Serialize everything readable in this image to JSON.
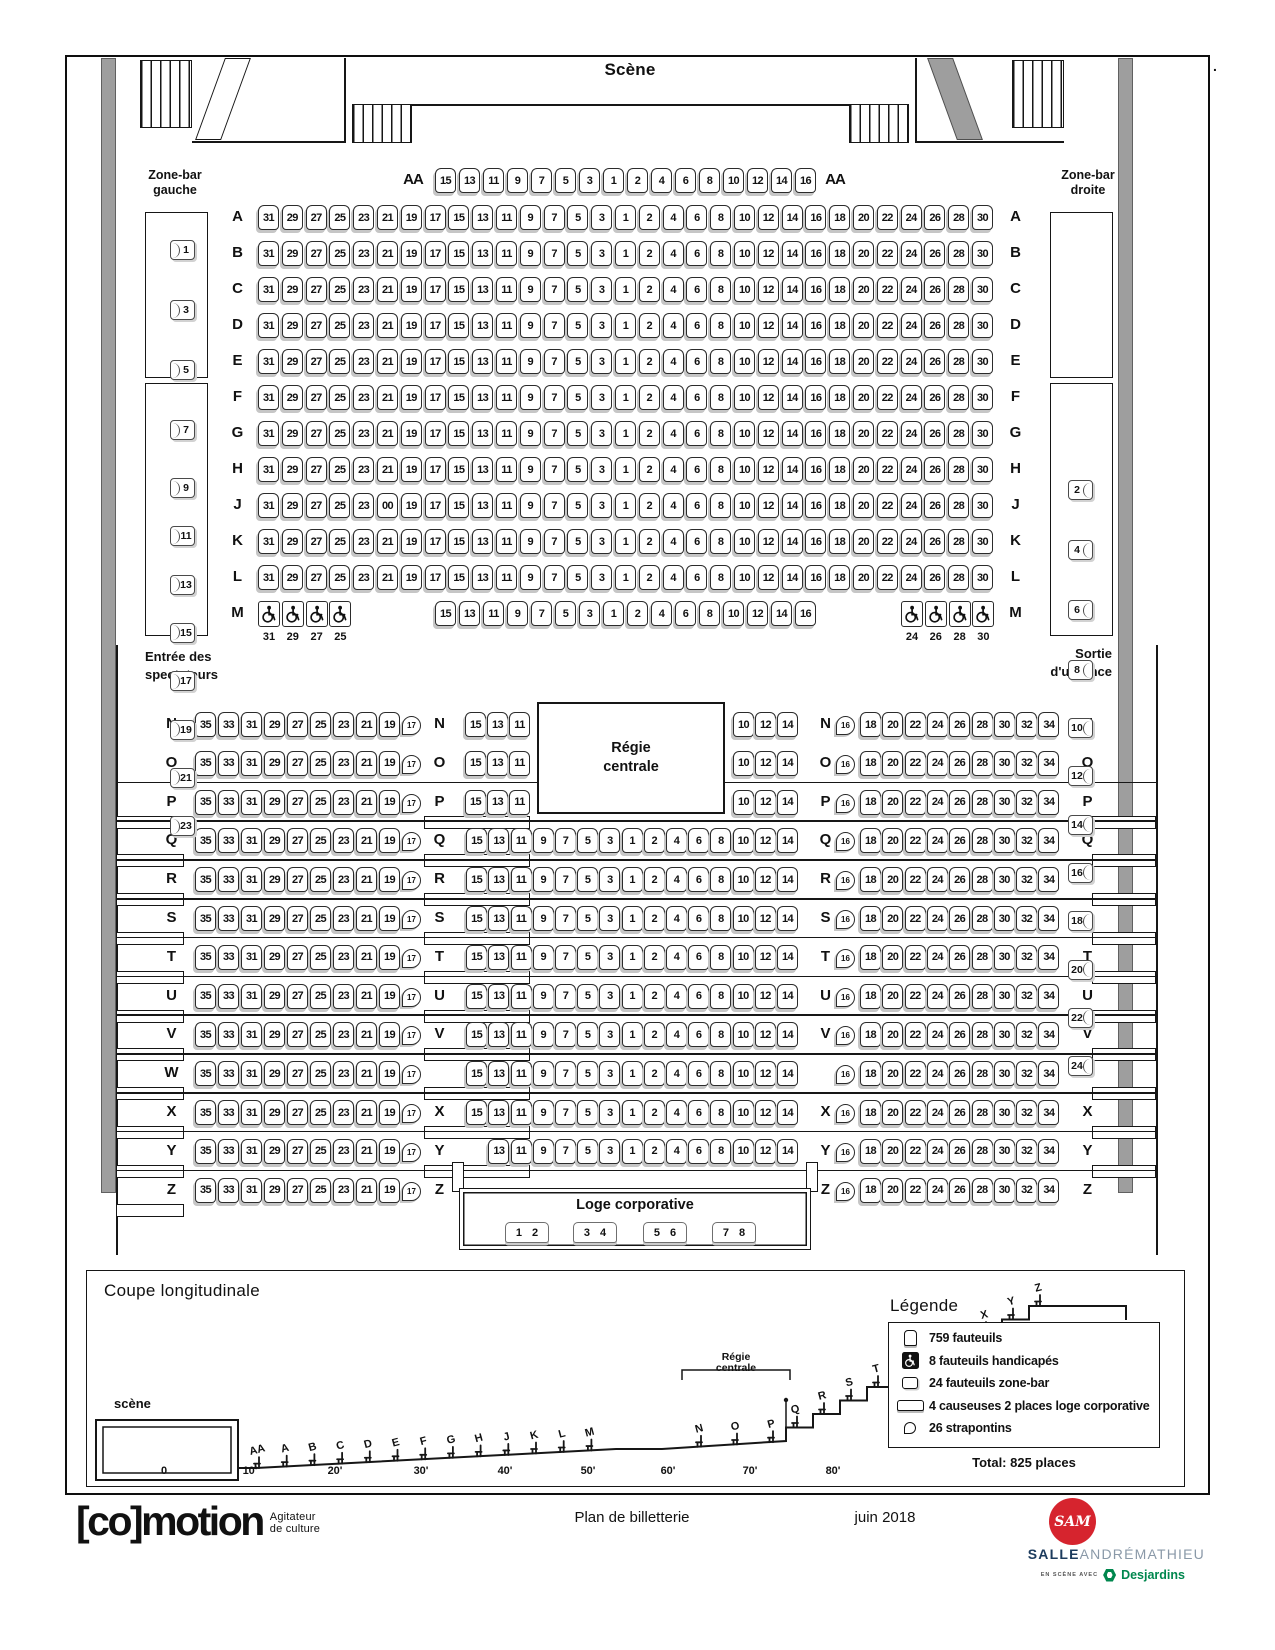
{
  "stage": {
    "label": "Scène"
  },
  "zone_bar_left": {
    "title_line1": "Zone-bar",
    "title_line2": "gauche",
    "top_seats": [
      "1",
      "3",
      "5",
      "7"
    ],
    "bottom_seats": [
      "9",
      "11",
      "13",
      "15",
      "17",
      "19",
      "21",
      "23"
    ]
  },
  "zone_bar_right": {
    "title_line1": "Zone-bar",
    "title_line2": "droite",
    "top_seats": [
      "2",
      "4",
      "6",
      "8"
    ],
    "bottom_seats": [
      "10",
      "12",
      "14",
      "16",
      "18",
      "20",
      "22",
      "24"
    ]
  },
  "signs": {
    "entrance_line1": "Entrée des",
    "entrance_line2": "spectateurs",
    "exit_line1": "Sortie",
    "exit_line2": "d'urgence"
  },
  "regie": {
    "line1": "Régie",
    "line2": "centrale"
  },
  "loge": {
    "title": "Loge corporative",
    "causeuses": [
      [
        "1",
        "2"
      ],
      [
        "3",
        "4"
      ],
      [
        "5",
        "6"
      ],
      [
        "7",
        "8"
      ]
    ]
  },
  "front_rows": [
    {
      "label": "AA",
      "seats": [
        "15",
        "13",
        "11",
        "9",
        "7",
        "5",
        "3",
        "1",
        "2",
        "4",
        "6",
        "8",
        "10",
        "12",
        "14",
        "16"
      ]
    },
    {
      "label": "A",
      "seats": [
        "31",
        "29",
        "27",
        "25",
        "23",
        "21",
        "19",
        "17",
        "15",
        "13",
        "11",
        "9",
        "7",
        "5",
        "3",
        "1",
        "2",
        "4",
        "6",
        "8",
        "10",
        "12",
        "14",
        "16",
        "18",
        "20",
        "22",
        "24",
        "26",
        "28",
        "30"
      ]
    },
    {
      "label": "B",
      "seats": [
        "31",
        "29",
        "27",
        "25",
        "23",
        "21",
        "19",
        "17",
        "15",
        "13",
        "11",
        "9",
        "7",
        "5",
        "3",
        "1",
        "2",
        "4",
        "6",
        "8",
        "10",
        "12",
        "14",
        "16",
        "18",
        "20",
        "22",
        "24",
        "26",
        "28",
        "30"
      ]
    },
    {
      "label": "C",
      "seats": [
        "31",
        "29",
        "27",
        "25",
        "23",
        "21",
        "19",
        "17",
        "15",
        "13",
        "11",
        "9",
        "7",
        "5",
        "3",
        "1",
        "2",
        "4",
        "6",
        "8",
        "10",
        "12",
        "14",
        "16",
        "18",
        "20",
        "22",
        "24",
        "26",
        "28",
        "30"
      ]
    },
    {
      "label": "D",
      "seats": [
        "31",
        "29",
        "27",
        "25",
        "23",
        "21",
        "19",
        "17",
        "15",
        "13",
        "11",
        "9",
        "7",
        "5",
        "3",
        "1",
        "2",
        "4",
        "6",
        "8",
        "10",
        "12",
        "14",
        "16",
        "18",
        "20",
        "22",
        "24",
        "26",
        "28",
        "30"
      ]
    },
    {
      "label": "E",
      "seats": [
        "31",
        "29",
        "27",
        "25",
        "23",
        "21",
        "19",
        "17",
        "15",
        "13",
        "11",
        "9",
        "7",
        "5",
        "3",
        "1",
        "2",
        "4",
        "6",
        "8",
        "10",
        "12",
        "14",
        "16",
        "18",
        "20",
        "22",
        "24",
        "26",
        "28",
        "30"
      ]
    },
    {
      "label": "F",
      "seats": [
        "31",
        "29",
        "27",
        "25",
        "23",
        "21",
        "19",
        "17",
        "15",
        "13",
        "11",
        "9",
        "7",
        "5",
        "3",
        "1",
        "2",
        "4",
        "6",
        "8",
        "10",
        "12",
        "14",
        "16",
        "18",
        "20",
        "22",
        "24",
        "26",
        "28",
        "30"
      ]
    },
    {
      "label": "G",
      "seats": [
        "31",
        "29",
        "27",
        "25",
        "23",
        "21",
        "19",
        "17",
        "15",
        "13",
        "11",
        "9",
        "7",
        "5",
        "3",
        "1",
        "2",
        "4",
        "6",
        "8",
        "10",
        "12",
        "14",
        "16",
        "18",
        "20",
        "22",
        "24",
        "26",
        "28",
        "30"
      ]
    },
    {
      "label": "H",
      "seats": [
        "31",
        "29",
        "27",
        "25",
        "23",
        "21",
        "19",
        "17",
        "15",
        "13",
        "11",
        "9",
        "7",
        "5",
        "3",
        "1",
        "2",
        "4",
        "6",
        "8",
        "10",
        "12",
        "14",
        "16",
        "18",
        "20",
        "22",
        "24",
        "26",
        "28",
        "30"
      ]
    },
    {
      "label": "J",
      "seats": [
        "31",
        "29",
        "27",
        "25",
        "23",
        "00",
        "19",
        "17",
        "15",
        "13",
        "11",
        "9",
        "7",
        "5",
        "3",
        "1",
        "2",
        "4",
        "6",
        "8",
        "10",
        "12",
        "14",
        "16",
        "18",
        "20",
        "22",
        "24",
        "26",
        "28",
        "30"
      ]
    },
    {
      "label": "K",
      "seats": [
        "31",
        "29",
        "27",
        "25",
        "23",
        "21",
        "19",
        "17",
        "15",
        "13",
        "11",
        "9",
        "7",
        "5",
        "3",
        "1",
        "2",
        "4",
        "6",
        "8",
        "10",
        "12",
        "14",
        "16",
        "18",
        "20",
        "22",
        "24",
        "26",
        "28",
        "30"
      ]
    },
    {
      "label": "L",
      "seats": [
        "31",
        "29",
        "27",
        "25",
        "23",
        "21",
        "19",
        "17",
        "15",
        "13",
        "11",
        "9",
        "7",
        "5",
        "3",
        "1",
        "2",
        "4",
        "6",
        "8",
        "10",
        "12",
        "14",
        "16",
        "18",
        "20",
        "22",
        "24",
        "26",
        "28",
        "30"
      ]
    },
    {
      "label": "M",
      "wheelchair_left": [
        "31",
        "29",
        "27",
        "25"
      ],
      "seats": [
        "15",
        "13",
        "11",
        "9",
        "7",
        "5",
        "3",
        "1",
        "2",
        "4",
        "6",
        "8",
        "10",
        "12",
        "14",
        "16"
      ],
      "wheelchair_right": [
        "24",
        "26",
        "28",
        "30"
      ]
    }
  ],
  "back_rows": [
    {
      "label": "N",
      "left": [
        "35",
        "33",
        "31",
        "29",
        "27",
        "25",
        "23",
        "21",
        "19"
      ],
      "strap_left": "17",
      "center_left": [
        "15",
        "13",
        "11"
      ],
      "center_right": [
        "10",
        "12",
        "14"
      ],
      "strap_right": "16",
      "right": [
        "18",
        "20",
        "22",
        "24",
        "26",
        "28",
        "30",
        "32",
        "34"
      ]
    },
    {
      "label": "O",
      "left": [
        "35",
        "33",
        "31",
        "29",
        "27",
        "25",
        "23",
        "21",
        "19"
      ],
      "strap_left": "17",
      "center_left": [
        "15",
        "13",
        "11"
      ],
      "center_right": [
        "10",
        "12",
        "14"
      ],
      "strap_right": "16",
      "right": [
        "18",
        "20",
        "22",
        "24",
        "26",
        "28",
        "30",
        "32",
        "34"
      ]
    },
    {
      "label": "P",
      "left": [
        "35",
        "33",
        "31",
        "29",
        "27",
        "25",
        "23",
        "21",
        "19"
      ],
      "strap_left": "17",
      "center_left": [
        "15",
        "13",
        "11"
      ],
      "center_right": [
        "10",
        "12",
        "14"
      ],
      "strap_right": "16",
      "right": [
        "18",
        "20",
        "22",
        "24",
        "26",
        "28",
        "30",
        "32",
        "34"
      ]
    },
    {
      "label": "Q",
      "left": [
        "35",
        "33",
        "31",
        "29",
        "27",
        "25",
        "23",
        "21",
        "19"
      ],
      "strap_left": "17",
      "center": [
        "15",
        "13",
        "11",
        "9",
        "7",
        "5",
        "3",
        "1",
        "2",
        "4",
        "6",
        "8",
        "10",
        "12",
        "14"
      ],
      "strap_right": "16",
      "right": [
        "18",
        "20",
        "22",
        "24",
        "26",
        "28",
        "30",
        "32",
        "34"
      ]
    },
    {
      "label": "R",
      "left": [
        "35",
        "33",
        "31",
        "29",
        "27",
        "25",
        "23",
        "21",
        "19"
      ],
      "strap_left": "17",
      "center": [
        "15",
        "13",
        "11",
        "9",
        "7",
        "5",
        "3",
        "1",
        "2",
        "4",
        "6",
        "8",
        "10",
        "12",
        "14"
      ],
      "strap_right": "16",
      "right": [
        "18",
        "20",
        "22",
        "24",
        "26",
        "28",
        "30",
        "32",
        "34"
      ]
    },
    {
      "label": "S",
      "left": [
        "35",
        "33",
        "31",
        "29",
        "27",
        "25",
        "23",
        "21",
        "19"
      ],
      "strap_left": "17",
      "center": [
        "15",
        "13",
        "11",
        "9",
        "7",
        "5",
        "3",
        "1",
        "2",
        "4",
        "6",
        "8",
        "10",
        "12",
        "14"
      ],
      "strap_right": "16",
      "right": [
        "18",
        "20",
        "22",
        "24",
        "26",
        "28",
        "30",
        "32",
        "34"
      ]
    },
    {
      "label": "T",
      "left": [
        "35",
        "33",
        "31",
        "29",
        "27",
        "25",
        "23",
        "21",
        "19"
      ],
      "strap_left": "17",
      "center": [
        "15",
        "13",
        "11",
        "9",
        "7",
        "5",
        "3",
        "1",
        "2",
        "4",
        "6",
        "8",
        "10",
        "12",
        "14"
      ],
      "strap_right": "16",
      "right": [
        "18",
        "20",
        "22",
        "24",
        "26",
        "28",
        "30",
        "32",
        "34"
      ]
    },
    {
      "label": "U",
      "left": [
        "35",
        "33",
        "31",
        "29",
        "27",
        "25",
        "23",
        "21",
        "19"
      ],
      "strap_left": "17",
      "center": [
        "15",
        "13",
        "11",
        "9",
        "7",
        "5",
        "3",
        "1",
        "2",
        "4",
        "6",
        "8",
        "10",
        "12",
        "14"
      ],
      "strap_right": "16",
      "right": [
        "18",
        "20",
        "22",
        "24",
        "26",
        "28",
        "30",
        "32",
        "34"
      ]
    },
    {
      "label": "V",
      "left": [
        "35",
        "33",
        "31",
        "29",
        "27",
        "25",
        "23",
        "21",
        "19"
      ],
      "strap_left": "17",
      "center": [
        "15",
        "13",
        "11",
        "9",
        "7",
        "5",
        "3",
        "1",
        "2",
        "4",
        "6",
        "8",
        "10",
        "12",
        "14"
      ],
      "strap_right": "16",
      "right": [
        "18",
        "20",
        "22",
        "24",
        "26",
        "28",
        "30",
        "32",
        "34"
      ]
    },
    {
      "label": "W",
      "show_labels": [
        "left"
      ],
      "left": [
        "35",
        "33",
        "31",
        "29",
        "27",
        "25",
        "23",
        "21",
        "19"
      ],
      "strap_left": "17",
      "center": [
        "15",
        "13",
        "11",
        "9",
        "7",
        "5",
        "3",
        "1",
        "2",
        "4",
        "6",
        "8",
        "10",
        "12",
        "14"
      ],
      "strap_right": "16",
      "right": [
        "18",
        "20",
        "22",
        "24",
        "26",
        "28",
        "30",
        "32",
        "34"
      ]
    },
    {
      "label": "X",
      "left": [
        "35",
        "33",
        "31",
        "29",
        "27",
        "25",
        "23",
        "21",
        "19"
      ],
      "strap_left": "17",
      "center": [
        "15",
        "13",
        "11",
        "9",
        "7",
        "5",
        "3",
        "1",
        "2",
        "4",
        "6",
        "8",
        "10",
        "12",
        "14"
      ],
      "strap_right": "16",
      "right": [
        "18",
        "20",
        "22",
        "24",
        "26",
        "28",
        "30",
        "32",
        "34"
      ]
    },
    {
      "label": "Y",
      "left": [
        "35",
        "33",
        "31",
        "29",
        "27",
        "25",
        "23",
        "21",
        "19"
      ],
      "strap_left": "17",
      "center": [
        "13",
        "11",
        "9",
        "7",
        "5",
        "3",
        "1",
        "2",
        "4",
        "6",
        "8",
        "10",
        "12",
        "14"
      ],
      "strap_right": "16",
      "right": [
        "18",
        "20",
        "22",
        "24",
        "26",
        "28",
        "30",
        "32",
        "34"
      ]
    },
    {
      "label": "Z",
      "has_loge": true,
      "left": [
        "35",
        "33",
        "31",
        "29",
        "27",
        "25",
        "23",
        "21",
        "19"
      ],
      "strap_left": "17",
      "strap_right": "16",
      "right": [
        "18",
        "20",
        "22",
        "24",
        "26",
        "28",
        "30",
        "32",
        "34"
      ]
    }
  ],
  "section_view": {
    "title": "Coupe longitudinale",
    "stage_label": "scène",
    "regie_line1": "Régie",
    "regie_line2": "centrale",
    "front_letters": [
      "AA",
      "A",
      "B",
      "C",
      "D",
      "E",
      "F",
      "G",
      "H",
      "J",
      "K",
      "L",
      "M"
    ],
    "mid_letters": [
      "N",
      "O",
      "P"
    ],
    "stair_letters": [
      "Q",
      "R",
      "S",
      "T",
      "U",
      "V",
      "W",
      "X",
      "Y",
      "Z"
    ],
    "scale_labels": [
      "0",
      "10'",
      "20'",
      "30'",
      "40'",
      "50'",
      "60'",
      "70'",
      "80'"
    ]
  },
  "legend": {
    "title": "Légende",
    "items": [
      {
        "icon": "seat-icon",
        "label": "759 fauteuils"
      },
      {
        "icon": "wheelchair-icon",
        "label": "8 fauteuils handicapés"
      },
      {
        "icon": "zonebar-seat-icon",
        "label": "24 fauteuils zone-bar"
      },
      {
        "icon": "loveseat-icon",
        "label": "4 causeuses 2 places loge corporative"
      },
      {
        "icon": "strapontin-icon",
        "label": "26 strapontins"
      }
    ],
    "total": "Total: 825 places"
  },
  "footer": {
    "logo_bracket": "[co]",
    "logo_word": "motion",
    "tagline_line1": "Agitateur",
    "tagline_line2": "de culture",
    "doc_title": "Plan de billetterie",
    "date": "juin 2018",
    "sam_monogram": "SAM",
    "brand_bold": "SALLE",
    "brand_light": "ANDRÉMATHIEU",
    "partner_prefix": "EN SCÈNE AVEC",
    "partner_name": "Desjardins",
    "stray_mark": "."
  },
  "colors": {
    "red": "#d6242e",
    "navy": "#1c3b5d",
    "steel": "#8a99a8",
    "green": "#00874e",
    "wall_gray": "#9e9e9e"
  }
}
